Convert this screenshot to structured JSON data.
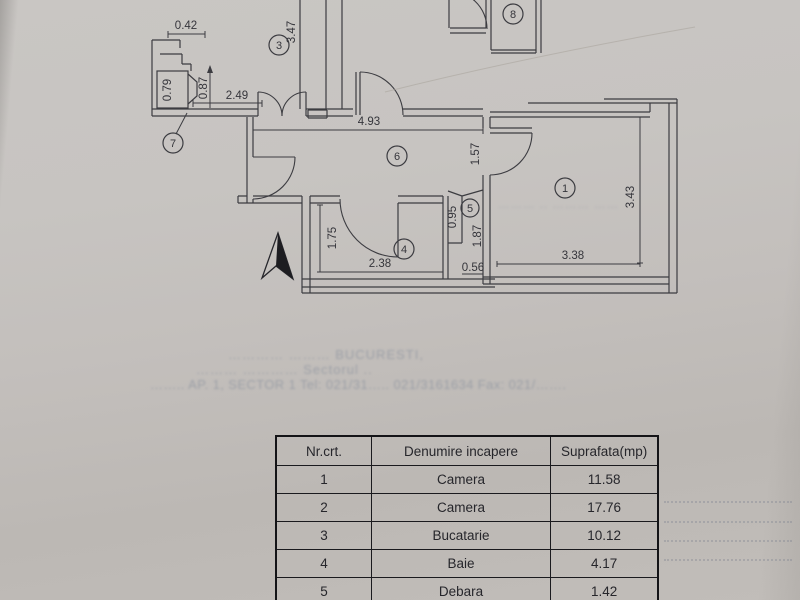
{
  "plan": {
    "room_numbers": {
      "r1": "1",
      "r3": "3",
      "r4": "4",
      "r5": "5",
      "r6": "6",
      "r7": "7",
      "r8": "8"
    },
    "dims": {
      "d042": "0.42",
      "d347": "3.47",
      "d079": "0.79",
      "d087": "0.87",
      "d249": "2.49",
      "d493": "4.93",
      "d157": "1.57",
      "d343": "3.43",
      "d338": "3.38",
      "d095": "0.95",
      "d187": "1.87",
      "d056": "0.56",
      "d175": "1.75",
      "d238": "2.38"
    }
  },
  "stamp": {
    "line1": "…………  ………  BUCURESTI,",
    "line2": "………  …………  Sectorul  ..",
    "line3": "……..  AP. 1,  SECTOR 1  Tel: 021/31…..  021/3161634  Fax: 021/…….",
    "room_note": "………  ..  ………  ……"
  },
  "table": {
    "headers": [
      "Nr.crt.",
      "Denumire incapere",
      "Suprafata(mp)"
    ],
    "rows": [
      [
        "1",
        "Camera",
        "11.58"
      ],
      [
        "2",
        "Camera",
        "17.76"
      ],
      [
        "3",
        "Bucatarie",
        "10.12"
      ],
      [
        "4",
        "Baie",
        "4.17"
      ],
      [
        "5",
        "Debara",
        "1.42"
      ]
    ]
  }
}
